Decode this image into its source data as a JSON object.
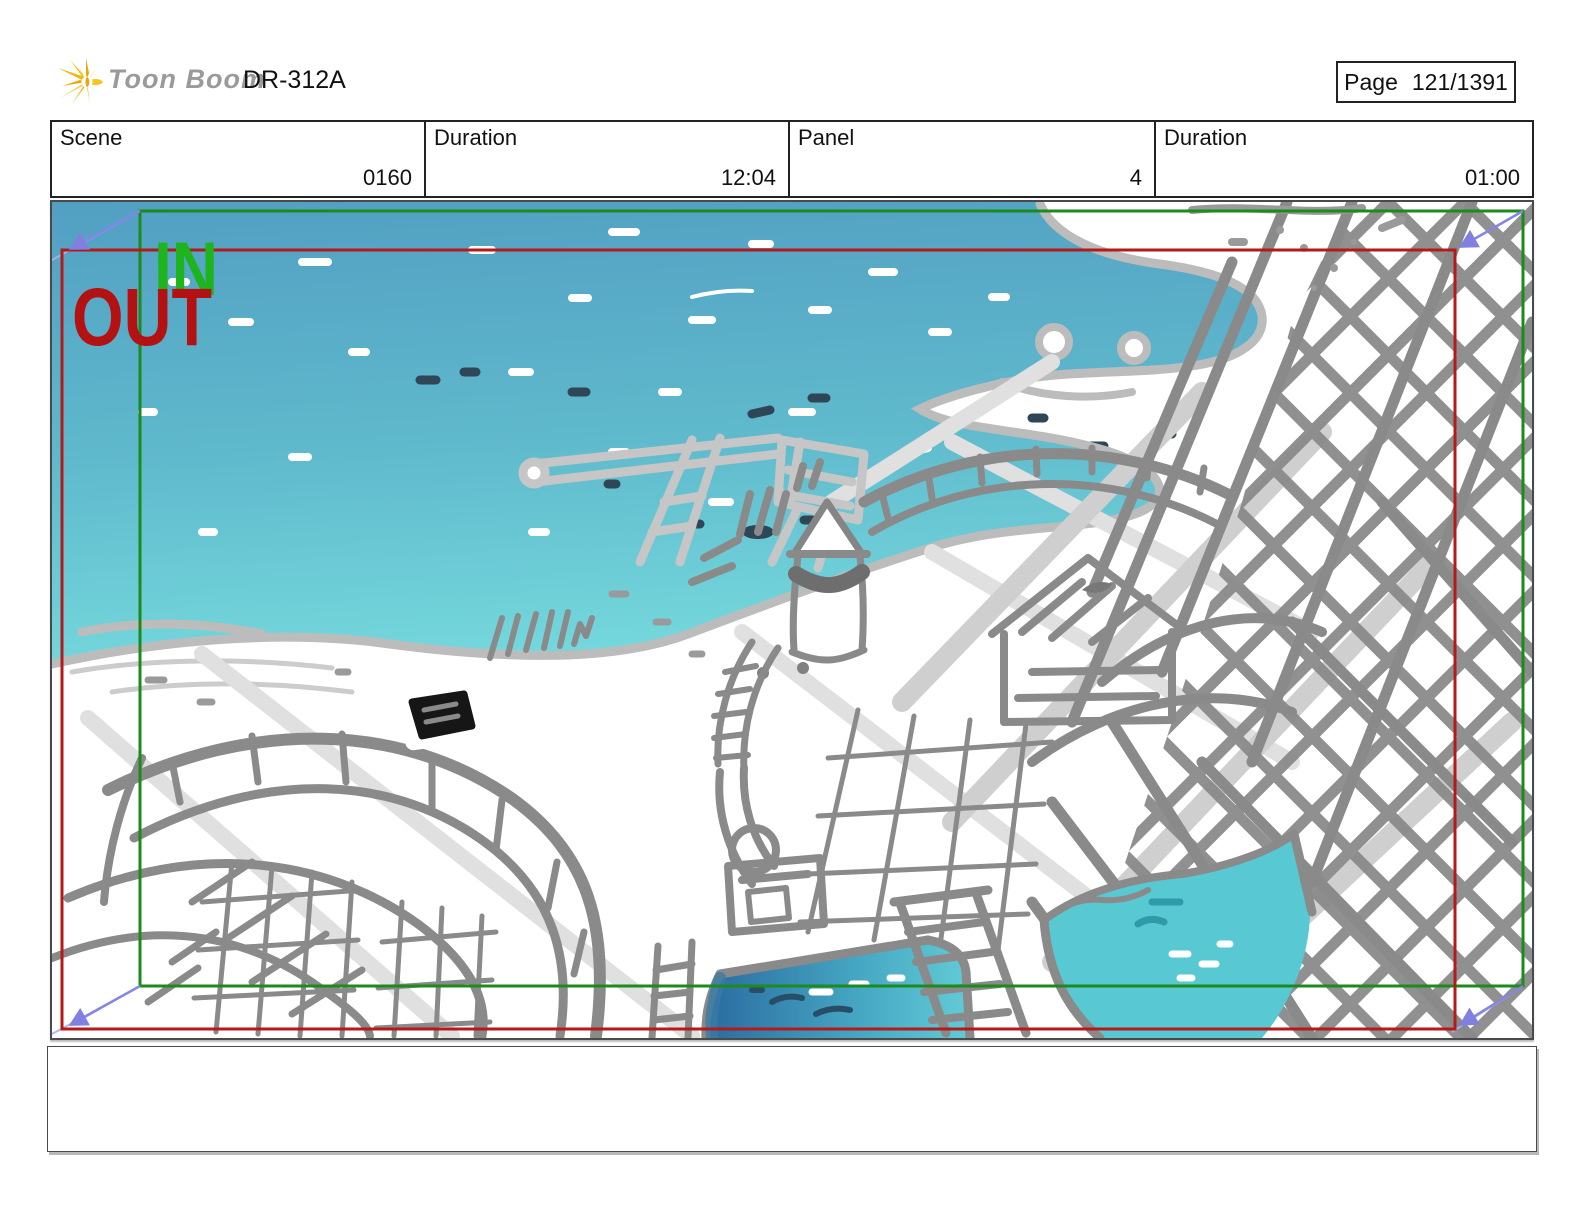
{
  "header": {
    "brand": "Toon Boom",
    "title": "DR-312A",
    "page_label": "Page",
    "page_value": "121/1391"
  },
  "infobar": {
    "cells": [
      {
        "label": "Scene",
        "value": "0160"
      },
      {
        "label": "Duration",
        "value": "12:04"
      },
      {
        "label": "Panel",
        "value": "4"
      },
      {
        "label": "Duration",
        "value": "01:00"
      }
    ]
  },
  "panel": {
    "in_label": "IN",
    "out_label": "OUT",
    "colors": {
      "in_text": "#1db41d",
      "out_text": "#b41212",
      "in_frame": "#1c8a1c",
      "out_frame": "#b41a1a",
      "camera_arrow": "#8585e6",
      "sea_top": "#529fc2",
      "sea_bottom": "#74d7dc",
      "pool_left_deep": "#2a6ba0",
      "pool_right": "#58c9d3",
      "sketch_gray": "#8a8a8a"
    }
  },
  "caption": {
    "text": ""
  }
}
